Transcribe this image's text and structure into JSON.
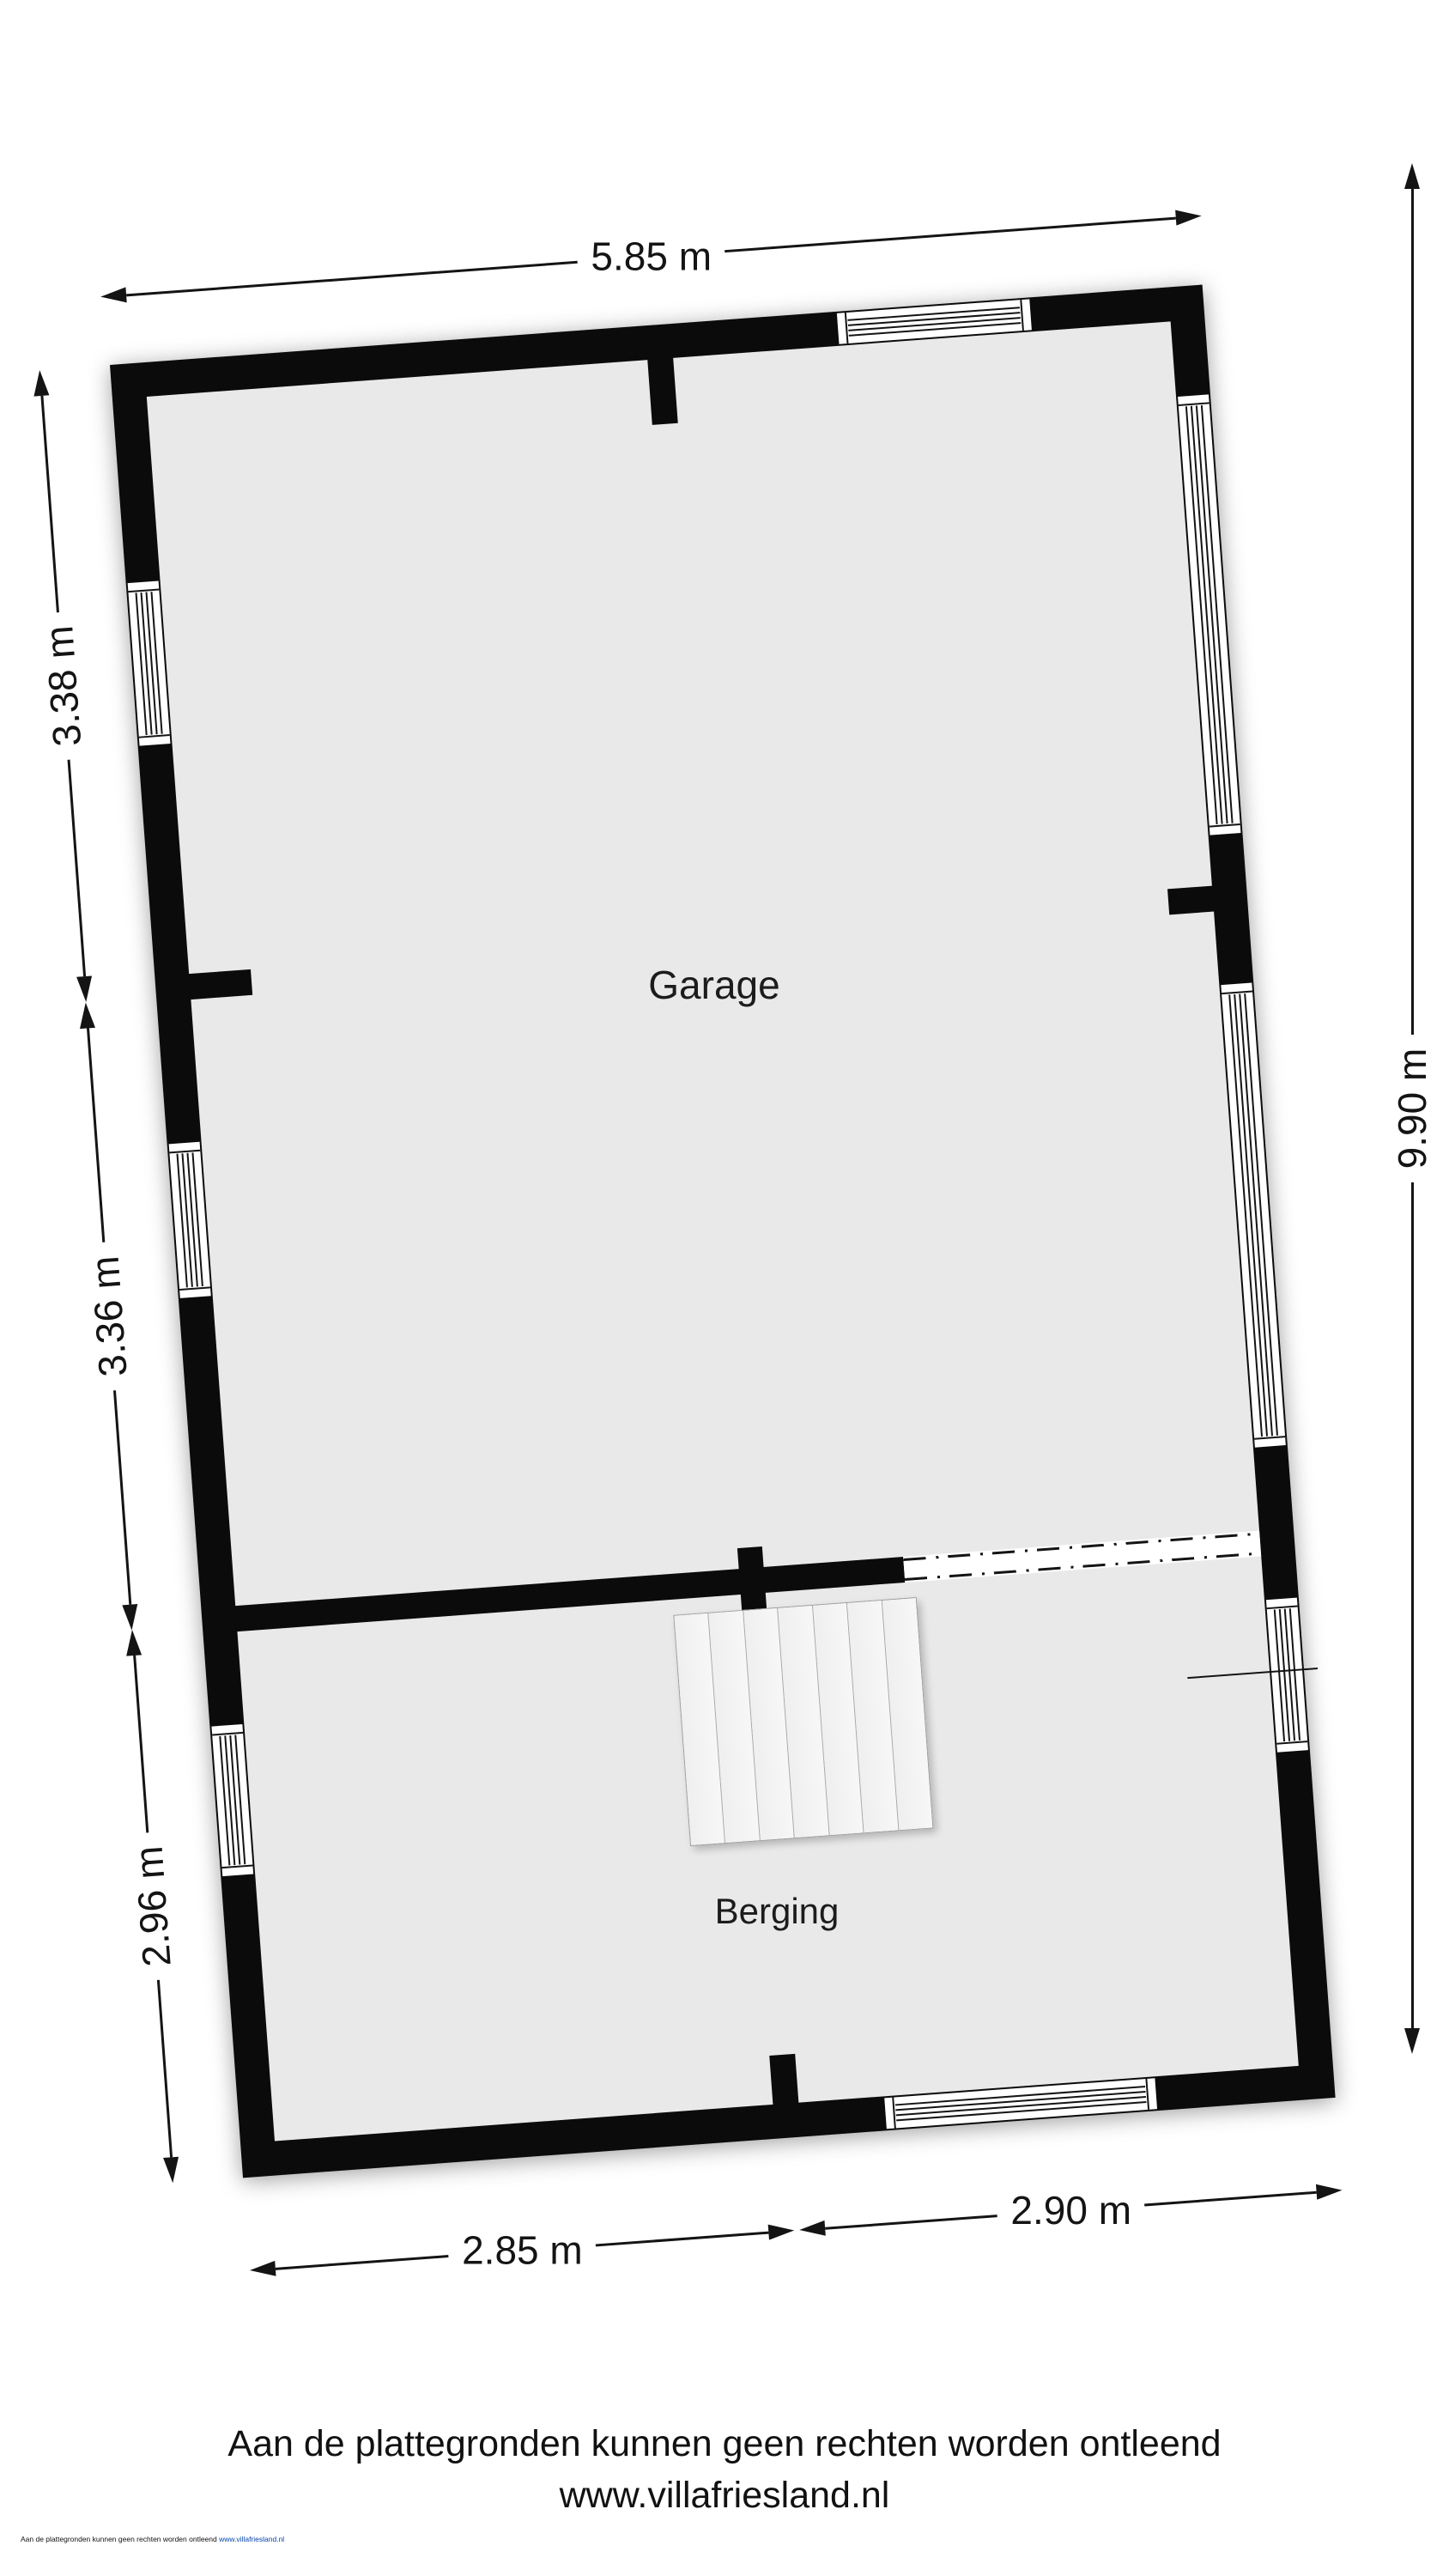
{
  "page": {
    "background": "#ffffff"
  },
  "plan": {
    "wall_color": "#0b0b0b",
    "floor_color": "#e9e9e9",
    "rotation_deg": -4.2,
    "rooms": [
      {
        "label": "Garage"
      },
      {
        "label": "Berging"
      }
    ],
    "stairs_treads": 7
  },
  "dimensions": {
    "top": "5.85 m",
    "left_upper": "3.38 m",
    "left_middle": "3.36 m",
    "left_lower": "2.96 m",
    "right": "9.90 m",
    "bottom_left": "2.85 m",
    "bottom_right": "2.90 m"
  },
  "footer": {
    "disclaimer": "Aan de plattegronden kunnen geen rechten worden ontleend",
    "website": "www.villafriesland.nl"
  },
  "fineprint": {
    "text": "Aan de plattegronden kunnen geen rechten worden ontleend",
    "link": "www.villafriesland.nl"
  }
}
